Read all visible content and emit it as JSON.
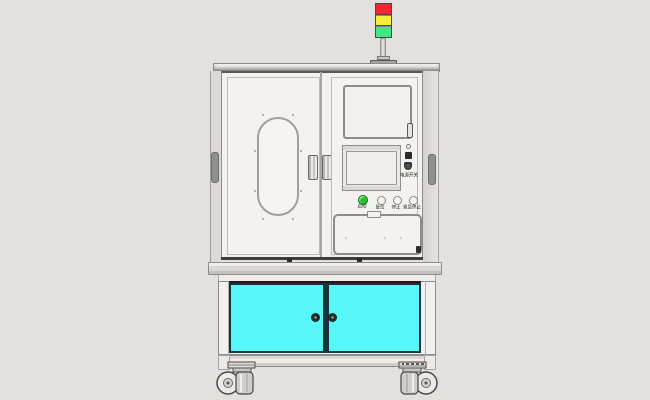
{
  "colors": {
    "background": "#e3e1e0",
    "body": "#f4f2f0",
    "frame_line": "#8e8c8a",
    "dark_line": "#3f3d3b",
    "side_strip": "#dcdad8",
    "door_cyan": "#57f6f8",
    "door_border": "#15343c",
    "tower_red": "#f3262c",
    "tower_yellow": "#f2ee3c",
    "tower_green": "#46e57e",
    "button_green": "#22c32a"
  },
  "tower": {
    "lights": [
      {
        "name": "red",
        "color": "#f3262c"
      },
      {
        "name": "yellow",
        "color": "#f2ee3c"
      },
      {
        "name": "green",
        "color": "#46e57e"
      }
    ]
  },
  "control_panel": {
    "side_switch_label": "电源开关",
    "buttons": [
      {
        "label": "启动",
        "type": "green"
      },
      {
        "label": "复位",
        "type": "plain"
      },
      {
        "label": "停止",
        "type": "plain"
      },
      {
        "label": "紧急停止",
        "type": "plain"
      }
    ]
  },
  "lower_cabinet": {
    "door_color": "#57f6f8",
    "door_count": 2,
    "knob_count": 2
  }
}
